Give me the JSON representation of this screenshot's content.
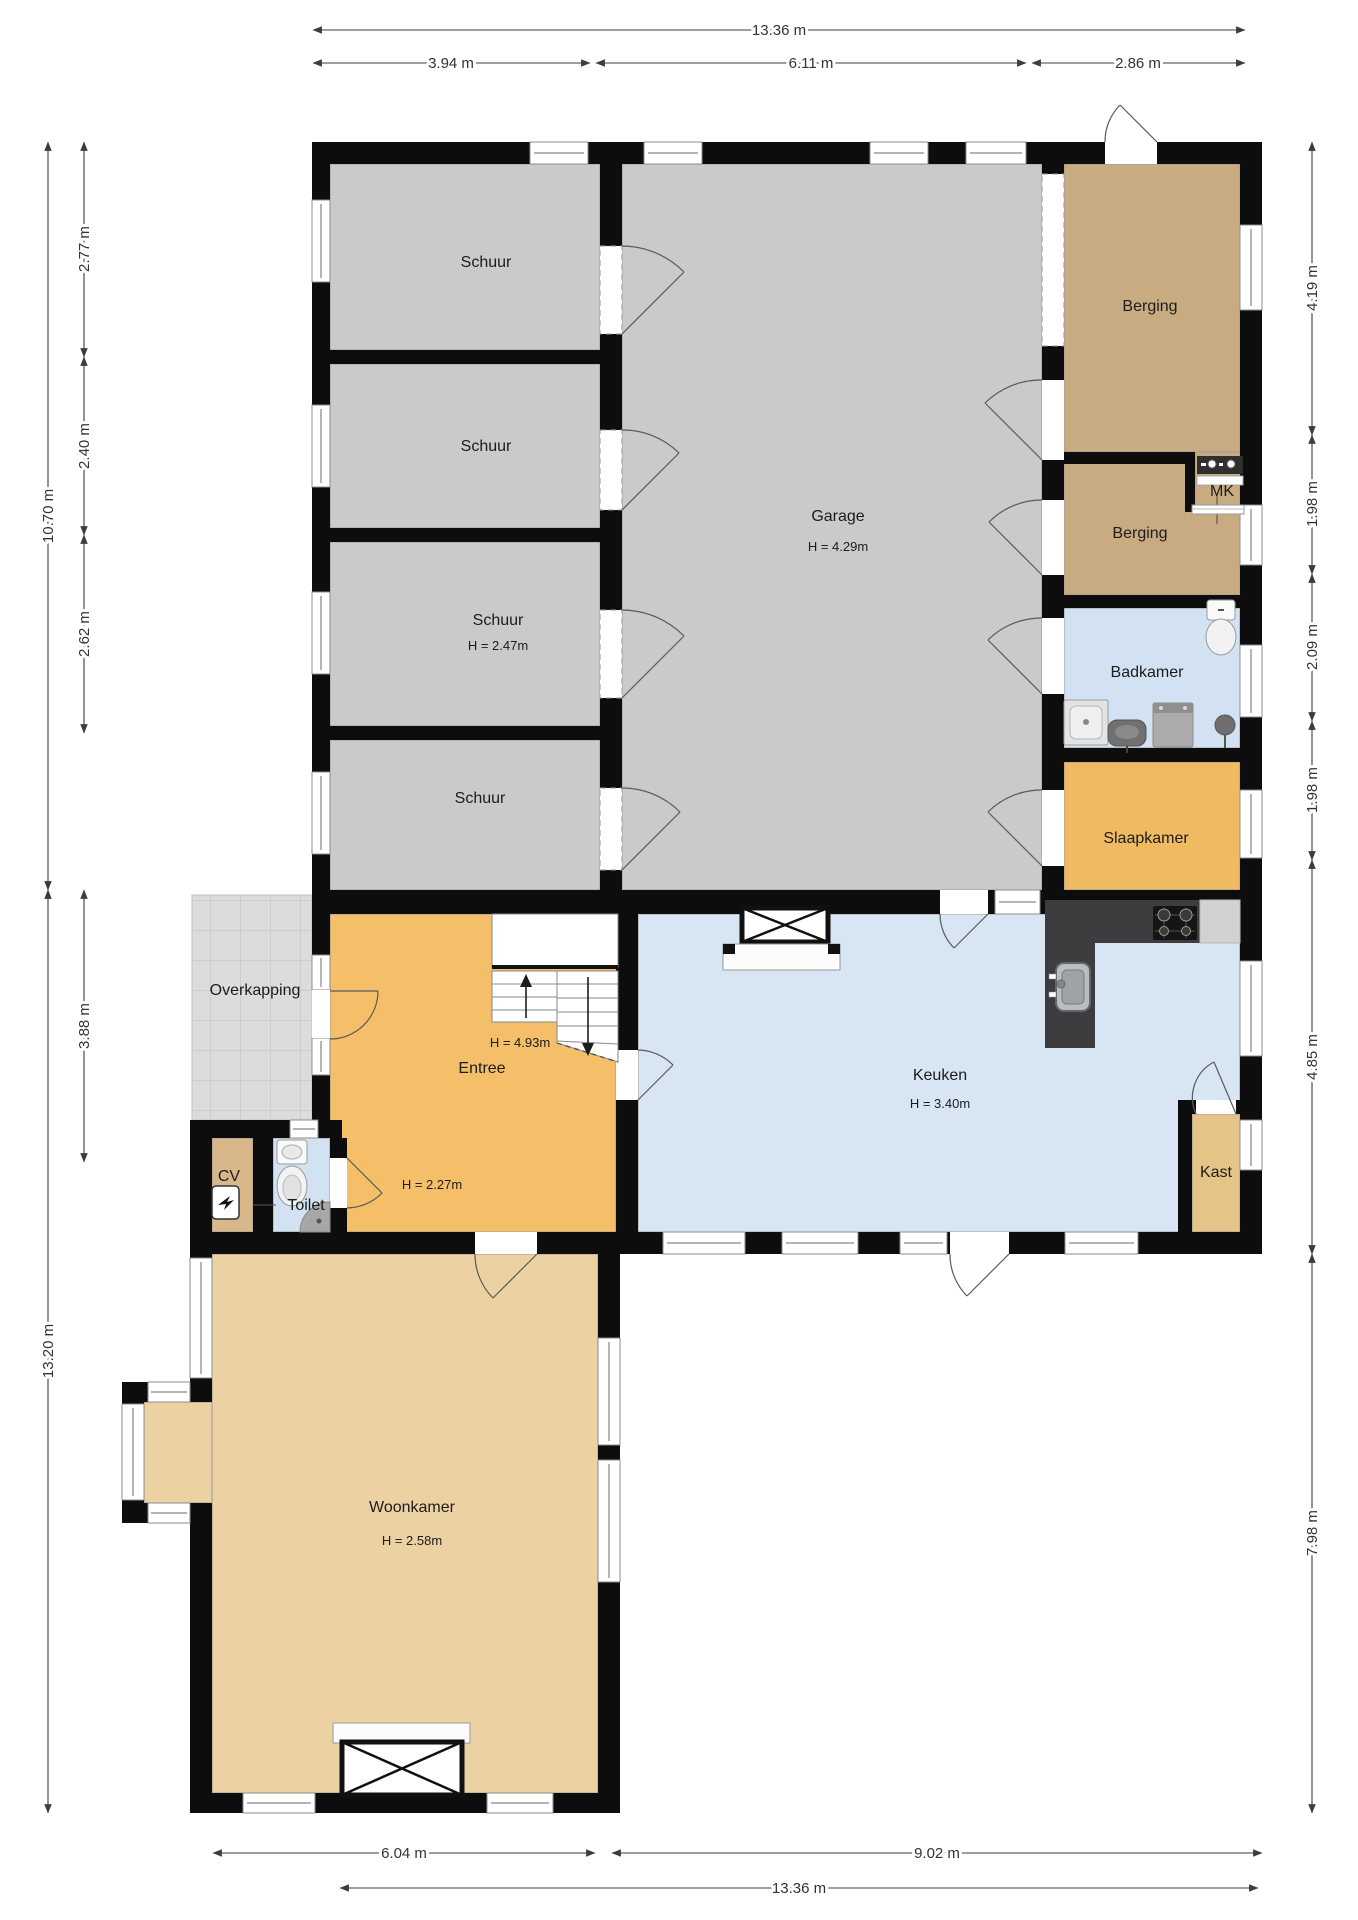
{
  "rooms": {
    "schuur_1": {
      "label": "Schuur"
    },
    "schuur_2": {
      "label": "Schuur"
    },
    "schuur_3": {
      "label": "Schuur",
      "height": "H = 2.47m"
    },
    "schuur_4": {
      "label": "Schuur"
    },
    "garage": {
      "label": "Garage",
      "height": "H = 4.29m"
    },
    "berging_1": {
      "label": "Berging"
    },
    "mk": {
      "label": "MK"
    },
    "berging_2": {
      "label": "Berging"
    },
    "badkamer": {
      "label": "Badkamer"
    },
    "slaapkamer": {
      "label": "Slaapkamer"
    },
    "keuken": {
      "label": "Keuken",
      "height": "H = 3.40m"
    },
    "kast": {
      "label": "Kast"
    },
    "entree": {
      "label": "Entree",
      "stair_height": "H = 4.93m",
      "height": "H = 2.27m"
    },
    "toilet": {
      "label": "Toilet"
    },
    "cv": {
      "label": "CV"
    },
    "overkapping": {
      "label": "Overkapping"
    },
    "woonkamer": {
      "label": "Woonkamer",
      "height": "H = 2.58m"
    }
  },
  "dimensions": {
    "top": [
      {
        "label": "13.36 m"
      },
      {
        "label": "3.94 m"
      },
      {
        "label": "6.11 m"
      },
      {
        "label": "2.86 m"
      }
    ],
    "bottom": [
      {
        "label": "6.04 m"
      },
      {
        "label": "9.02 m"
      },
      {
        "label": "13.36 m"
      }
    ],
    "left": [
      {
        "label": "10.70 m"
      },
      {
        "label": "2.77 m"
      },
      {
        "label": "2.40 m"
      },
      {
        "label": "2.62 m"
      },
      {
        "label": "3.88 m"
      },
      {
        "label": "13.20 m"
      }
    ],
    "right": [
      {
        "label": "4.19 m"
      },
      {
        "label": "1.98 m"
      },
      {
        "label": "2.09 m"
      },
      {
        "label": "1.98 m"
      },
      {
        "label": "4.85 m"
      },
      {
        "label": "7.98 m"
      }
    ]
  },
  "colors": {
    "wall": "#0d0d0d",
    "shed_garage_floor": "#cacaca",
    "storage_floor": "#c8ab80",
    "bathroom_floor": "#d3e2f2",
    "bedroom_floor": "#f0ba62",
    "entree_floor": "#f4bf68",
    "kitchen_floor": "#d8e6f4",
    "living_floor": "#ecd2a2",
    "kast_floor": "#e6c488",
    "cv_floor": "#d8b88a",
    "canopy_floor": "#dcdcdc",
    "counter": "#3d3d40",
    "dimension_text": "#333333",
    "label_text": "#1c1c1c"
  }
}
